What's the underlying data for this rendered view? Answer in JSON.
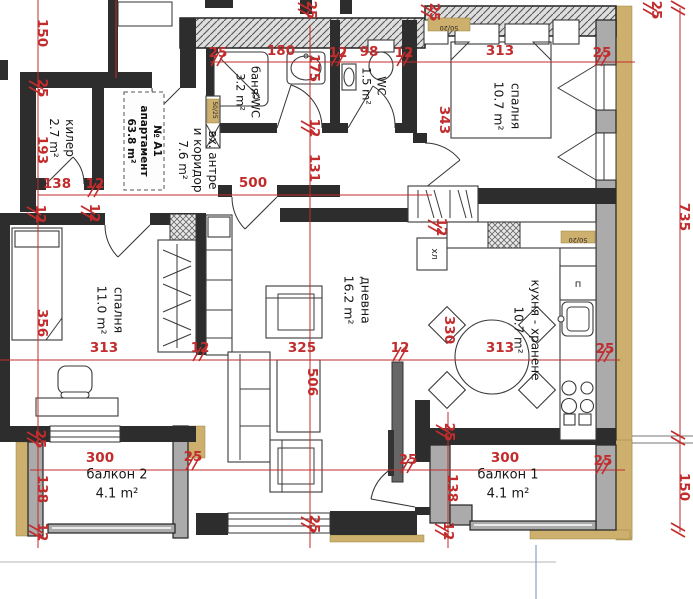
{
  "title": "№ А1 апартамент 63.8 m²",
  "colors": {
    "dimension_red": "#c22c2c",
    "wall_dark": "#2d2d2d",
    "wall_gray": "#ababab",
    "insulation_tan": "#cdaf6e",
    "ground_line_blue": "#8aa0c4"
  },
  "apartment_box": {
    "lines": [
      "№ А1",
      "апартамент",
      "63.8 m²"
    ]
  },
  "rooms": [
    {
      "id": "kiler",
      "lines": [
        "килер",
        "2.7 m²"
      ],
      "x": 62,
      "y": 138,
      "r": 90,
      "size": 12,
      "lh": 16
    },
    {
      "id": "antre",
      "lines": [
        "вх. антре",
        "и коридор",
        "7.6 m²"
      ],
      "x": 198,
      "y": 160,
      "r": 90,
      "size": 12,
      "lh": 15
    },
    {
      "id": "bania",
      "lines": [
        "баня-WC",
        "3.2 m²"
      ],
      "x": 248,
      "y": 92,
      "r": 90,
      "size": 11.5,
      "lh": 15
    },
    {
      "id": "wc",
      "lines": [
        "WC",
        "1.5 m²"
      ],
      "x": 374,
      "y": 86,
      "r": 90,
      "size": 11.5,
      "lh": 15
    },
    {
      "id": "spalnia1",
      "lines": [
        "спалня",
        "10.7 m²"
      ],
      "x": 507,
      "y": 106,
      "r": 90,
      "size": 12.5,
      "lh": 17
    },
    {
      "id": "spalnia2",
      "lines": [
        "спалня",
        "11.0 m²"
      ],
      "x": 110,
      "y": 310,
      "r": 90,
      "size": 12.5,
      "lh": 17
    },
    {
      "id": "dnevna",
      "lines": [
        "дневна",
        "16.2 m²"
      ],
      "x": 357,
      "y": 300,
      "r": 90,
      "size": 12.5,
      "lh": 17
    },
    {
      "id": "kuhnia",
      "lines": [
        "кухня - хранене",
        "10.7 m²"
      ],
      "x": 527,
      "y": 330,
      "r": 90,
      "size": 12,
      "lh": 17
    },
    {
      "id": "balkon2",
      "lines": [
        "балкон 2",
        "4.1 m²"
      ],
      "x": 117,
      "y": 484,
      "r": 0,
      "size": 13,
      "lh": 19
    },
    {
      "id": "balkon1",
      "lines": [
        "балкон 1",
        "4.1 m²"
      ],
      "x": 508,
      "y": 484,
      "r": 0,
      "size": 13,
      "lh": 19
    }
  ],
  "small_labels": [
    {
      "t": "хл",
      "x": 432,
      "y": 254,
      "r": 90,
      "size": 9
    },
    {
      "t": "п",
      "x": 578,
      "y": 287,
      "r": 0,
      "size": 10
    },
    {
      "t": "50/20",
      "x": 449,
      "y": 26,
      "r": 180,
      "size": 6.5
    },
    {
      "t": "50/20",
      "x": 578,
      "y": 238,
      "r": 180,
      "size": 6.5
    },
    {
      "t": "50/25",
      "x": 213,
      "y": 110,
      "r": 90,
      "size": 6
    }
  ],
  "dimensions": [
    {
      "t": "150",
      "x": 38,
      "y": 33,
      "r": 90,
      "s": false
    },
    {
      "t": "25",
      "x": 38,
      "y": 88,
      "r": 90,
      "s": true
    },
    {
      "t": "193",
      "x": 38,
      "y": 150,
      "r": 90,
      "s": false
    },
    {
      "t": "12",
      "x": 36,
      "y": 214,
      "r": 90,
      "s": true
    },
    {
      "t": "12",
      "x": 90,
      "y": 213,
      "r": 90,
      "s": true
    },
    {
      "t": "356",
      "x": 38,
      "y": 323,
      "r": 90,
      "s": false
    },
    {
      "t": "25",
      "x": 36,
      "y": 439,
      "r": 90,
      "s": true
    },
    {
      "t": "138",
      "x": 38,
      "y": 489,
      "r": 90,
      "s": false
    },
    {
      "t": "12",
      "x": 38,
      "y": 532,
      "r": 90,
      "s": true
    },
    {
      "t": "25",
      "x": 218,
      "y": 57,
      "r": 0,
      "s": true
    },
    {
      "t": "180",
      "x": 281,
      "y": 55,
      "r": 0,
      "s": false
    },
    {
      "t": "12",
      "x": 338,
      "y": 57,
      "r": 0,
      "s": true
    },
    {
      "t": "98",
      "x": 369,
      "y": 56,
      "r": 0,
      "s": false
    },
    {
      "t": "12",
      "x": 404,
      "y": 57,
      "r": 0,
      "s": true
    },
    {
      "t": "313",
      "x": 500,
      "y": 55,
      "r": 0,
      "s": false
    },
    {
      "t": "25",
      "x": 602,
      "y": 57,
      "r": 0,
      "s": true
    },
    {
      "t": "138",
      "x": 57,
      "y": 188,
      "r": 0,
      "s": false
    },
    {
      "t": "12",
      "x": 95,
      "y": 188,
      "r": 0,
      "s": true
    },
    {
      "t": "500",
      "x": 253,
      "y": 187,
      "r": 0,
      "s": false
    },
    {
      "t": "175",
      "x": 310,
      "y": 68,
      "r": 90,
      "s": false
    },
    {
      "t": "12",
      "x": 310,
      "y": 128,
      "r": 90,
      "s": true
    },
    {
      "t": "131",
      "x": 310,
      "y": 168,
      "r": 90,
      "s": false
    },
    {
      "t": "506",
      "x": 308,
      "y": 382,
      "r": 90,
      "s": false
    },
    {
      "t": "25",
      "x": 310,
      "y": 524,
      "r": 90,
      "s": true
    },
    {
      "t": "313",
      "x": 104,
      "y": 352,
      "r": 0,
      "s": false
    },
    {
      "t": "12",
      "x": 200,
      "y": 352,
      "r": 0,
      "s": true
    },
    {
      "t": "325",
      "x": 302,
      "y": 352,
      "r": 0,
      "s": false
    },
    {
      "t": "12",
      "x": 400,
      "y": 352,
      "r": 0,
      "s": true
    },
    {
      "t": "313",
      "x": 500,
      "y": 352,
      "r": 0,
      "s": false
    },
    {
      "t": "25",
      "x": 605,
      "y": 353,
      "r": 0,
      "s": true
    },
    {
      "t": "330",
      "x": 445,
      "y": 330,
      "r": 90,
      "s": false
    },
    {
      "t": "343",
      "x": 440,
      "y": 120,
      "r": 90,
      "s": false
    },
    {
      "t": "12",
      "x": 437,
      "y": 227,
      "r": 90,
      "s": true
    },
    {
      "t": "25",
      "x": 193,
      "y": 461,
      "r": 0,
      "s": true
    },
    {
      "t": "300",
      "x": 100,
      "y": 462,
      "r": 0,
      "s": false
    },
    {
      "t": "25",
      "x": 408,
      "y": 464,
      "r": 0,
      "s": true
    },
    {
      "t": "300",
      "x": 505,
      "y": 462,
      "r": 0,
      "s": false
    },
    {
      "t": "25",
      "x": 603,
      "y": 465,
      "r": 0,
      "s": true
    },
    {
      "t": "25",
      "x": 445,
      "y": 432,
      "r": 90,
      "s": true
    },
    {
      "t": "138",
      "x": 448,
      "y": 488,
      "r": 90,
      "s": false
    },
    {
      "t": "12",
      "x": 444,
      "y": 531,
      "r": 90,
      "s": true
    },
    {
      "t": "735",
      "x": 680,
      "y": 217,
      "r": 90,
      "s": false
    },
    {
      "t": "150",
      "x": 680,
      "y": 487,
      "r": 90,
      "s": false
    },
    {
      "t": "25",
      "x": 307,
      "y": 10,
      "r": 90,
      "s": true
    },
    {
      "t": "25",
      "x": 430,
      "y": 12,
      "r": 90,
      "s": true
    },
    {
      "t": "25",
      "x": 652,
      "y": 10,
      "r": 90,
      "s": true
    },
    {
      "t": "",
      "x": 680,
      "y": 8,
      "r": 90,
      "s": true
    },
    {
      "t": "",
      "x": 680,
      "y": 438,
      "r": 90,
      "s": true
    },
    {
      "t": "",
      "x": 680,
      "y": 530,
      "r": 90,
      "s": true
    }
  ]
}
